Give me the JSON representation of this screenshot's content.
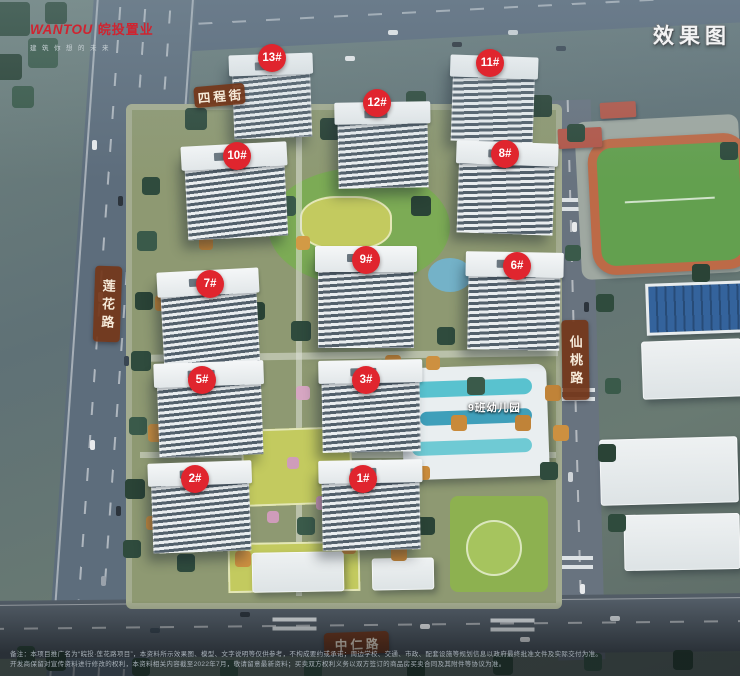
{
  "brand": {
    "logo_en": "WANTOU",
    "logo_cn": "皖投置业",
    "tagline": "建筑你想的未来"
  },
  "watermark": "效果图",
  "roads": {
    "top": "四程街",
    "left": "莲花路",
    "right": "仙桃路",
    "bottom": "中仁路"
  },
  "site": {
    "kindergarten_label": "9班幼儿园"
  },
  "buildings": [
    {
      "label": "1#"
    },
    {
      "label": "2#"
    },
    {
      "label": "3#"
    },
    {
      "label": "5#"
    },
    {
      "label": "6#"
    },
    {
      "label": "7#"
    },
    {
      "label": "8#"
    },
    {
      "label": "9#"
    },
    {
      "label": "10#"
    },
    {
      "label": "11#"
    },
    {
      "label": "12#"
    },
    {
      "label": "13#"
    }
  ],
  "disclaimer": {
    "line1": "备注：本项目推广名为“皖投·莲花路项目”，本资料所示效果图、模型、文字说明等仅供参考，不构成要约或承诺；周边学校、交通、市政、配套设施等规划信息以政府最终批准文件及实际交付为准。",
    "line2": "开发商保留对宣传资料进行修改的权利，本资料相关内容截至2022年7月，敬请留意最新资料；买卖双方权利义务以双方签订的商品房买卖合同及其附件等协议为准。"
  },
  "colors": {
    "badge_red": "#e0252e",
    "banner_brown": "#74371a",
    "logo_red": "#cf2430",
    "track_orange": "#bd6a47",
    "field_green": "#63a04f"
  }
}
